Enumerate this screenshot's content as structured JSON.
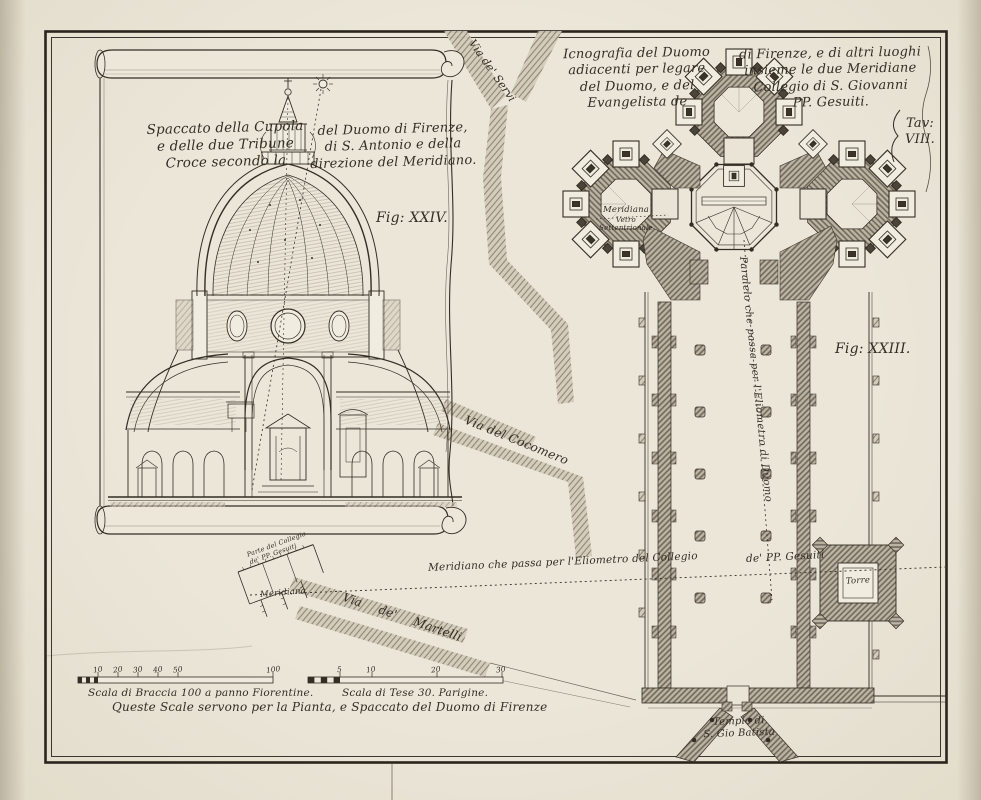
{
  "plate": {
    "tav_line1": "Tav:",
    "tav_line2": "VIII."
  },
  "section": {
    "title_left": [
      "Spaccato della Cupola",
      "e delle due Tribune",
      "Croce secondo la"
    ],
    "title_right": [
      "del Duomo di Firenze,",
      "di S. Antonio e della",
      "direzione del Meridiano."
    ],
    "fig_label": "Fig: XXIV."
  },
  "plan": {
    "title_left": [
      "Icnografia del Duomo",
      "adiacenti per legare",
      "del Duomo, e del",
      "Evangelista de"
    ],
    "title_right": [
      "di Firenze, e di altri luoghi",
      "insieme le due Meridiane",
      "Collegio di S. Giovanni",
      "PP. Gesuiti."
    ],
    "fig_label": "Fig: XXIII.",
    "torre_label": "Torre",
    "meridiana_note": {
      "line1": "Meridiana",
      "line2": "Vetro",
      "line3": "Settentrionale"
    },
    "paralelo_label": "Paralelo che passa per l'Eliometro di Duomo"
  },
  "streets": {
    "servi": "Via de' Servi",
    "cocomero": "Via del Cocomero",
    "martelli": "Via de' Martelli"
  },
  "meridian": {
    "part1": "Meridiano che passa per l'Eliometro del Collegio",
    "part2": "de' PP. Gesuiti"
  },
  "collegio": {
    "caption_line1": "Parte del Collegio",
    "caption_line2": "de' PP. Gesuiti",
    "meridiana_label": "Meridiana"
  },
  "tempio": {
    "line1": "Tempio di",
    "line2": "S. Gio Batista"
  },
  "scales": {
    "braccia": {
      "ticks": [
        "10",
        "20",
        "30",
        "40",
        "50",
        "100"
      ],
      "label": "Scala di Braccia 100 a panno Fiorentine."
    },
    "tese": {
      "ticks": [
        "5",
        "10",
        "20",
        "30"
      ],
      "label": "Scala di Tese 30. Parigine."
    },
    "note": "Queste Scale servono per la Pianta, e Spaccato del Duomo di Firenze"
  },
  "colors": {
    "paper": "#e9e4d5",
    "ink": "#332d24",
    "wall_hatch": "#6e675a",
    "street_hatch": "#8a8172"
  }
}
